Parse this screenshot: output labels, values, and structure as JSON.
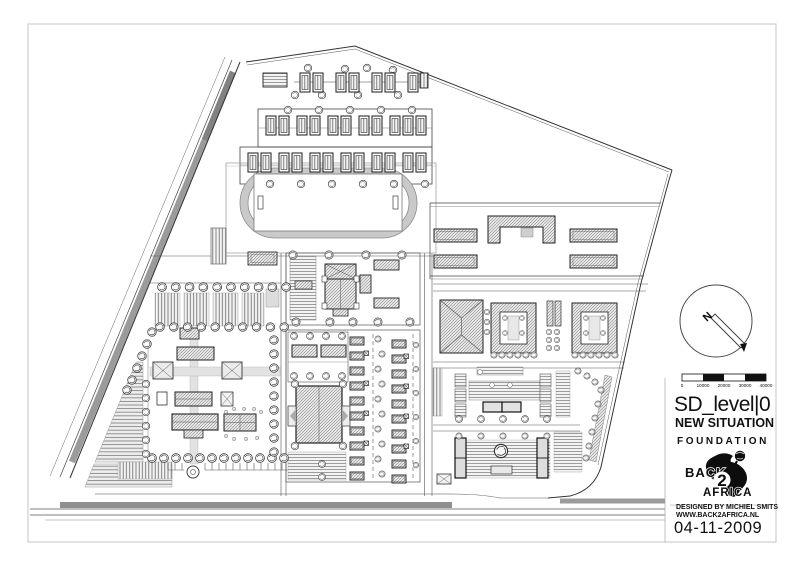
{
  "title_block": {
    "title": "SD_level|0",
    "subtitle": "NEW SITUATION",
    "client": "FOUNDATION",
    "credit_line1": "DESIGNED BY MICHIEL SMITS",
    "credit_line2": "WWW.BACK2AFRICA.NL",
    "date": "04-11-2009"
  },
  "logo": {
    "word_back": "BACK",
    "word_two": "2",
    "word_africa": "AFRICA"
  },
  "compass": {
    "north_label": "N"
  },
  "scale_bar": {
    "labels": [
      "0",
      "10000",
      "20000",
      "30000",
      "40000"
    ]
  },
  "colors": {
    "paper": "#ffffff",
    "line": "#333333",
    "road_gray": "#9b9b9b",
    "track_gray": "#c9c9c9"
  }
}
